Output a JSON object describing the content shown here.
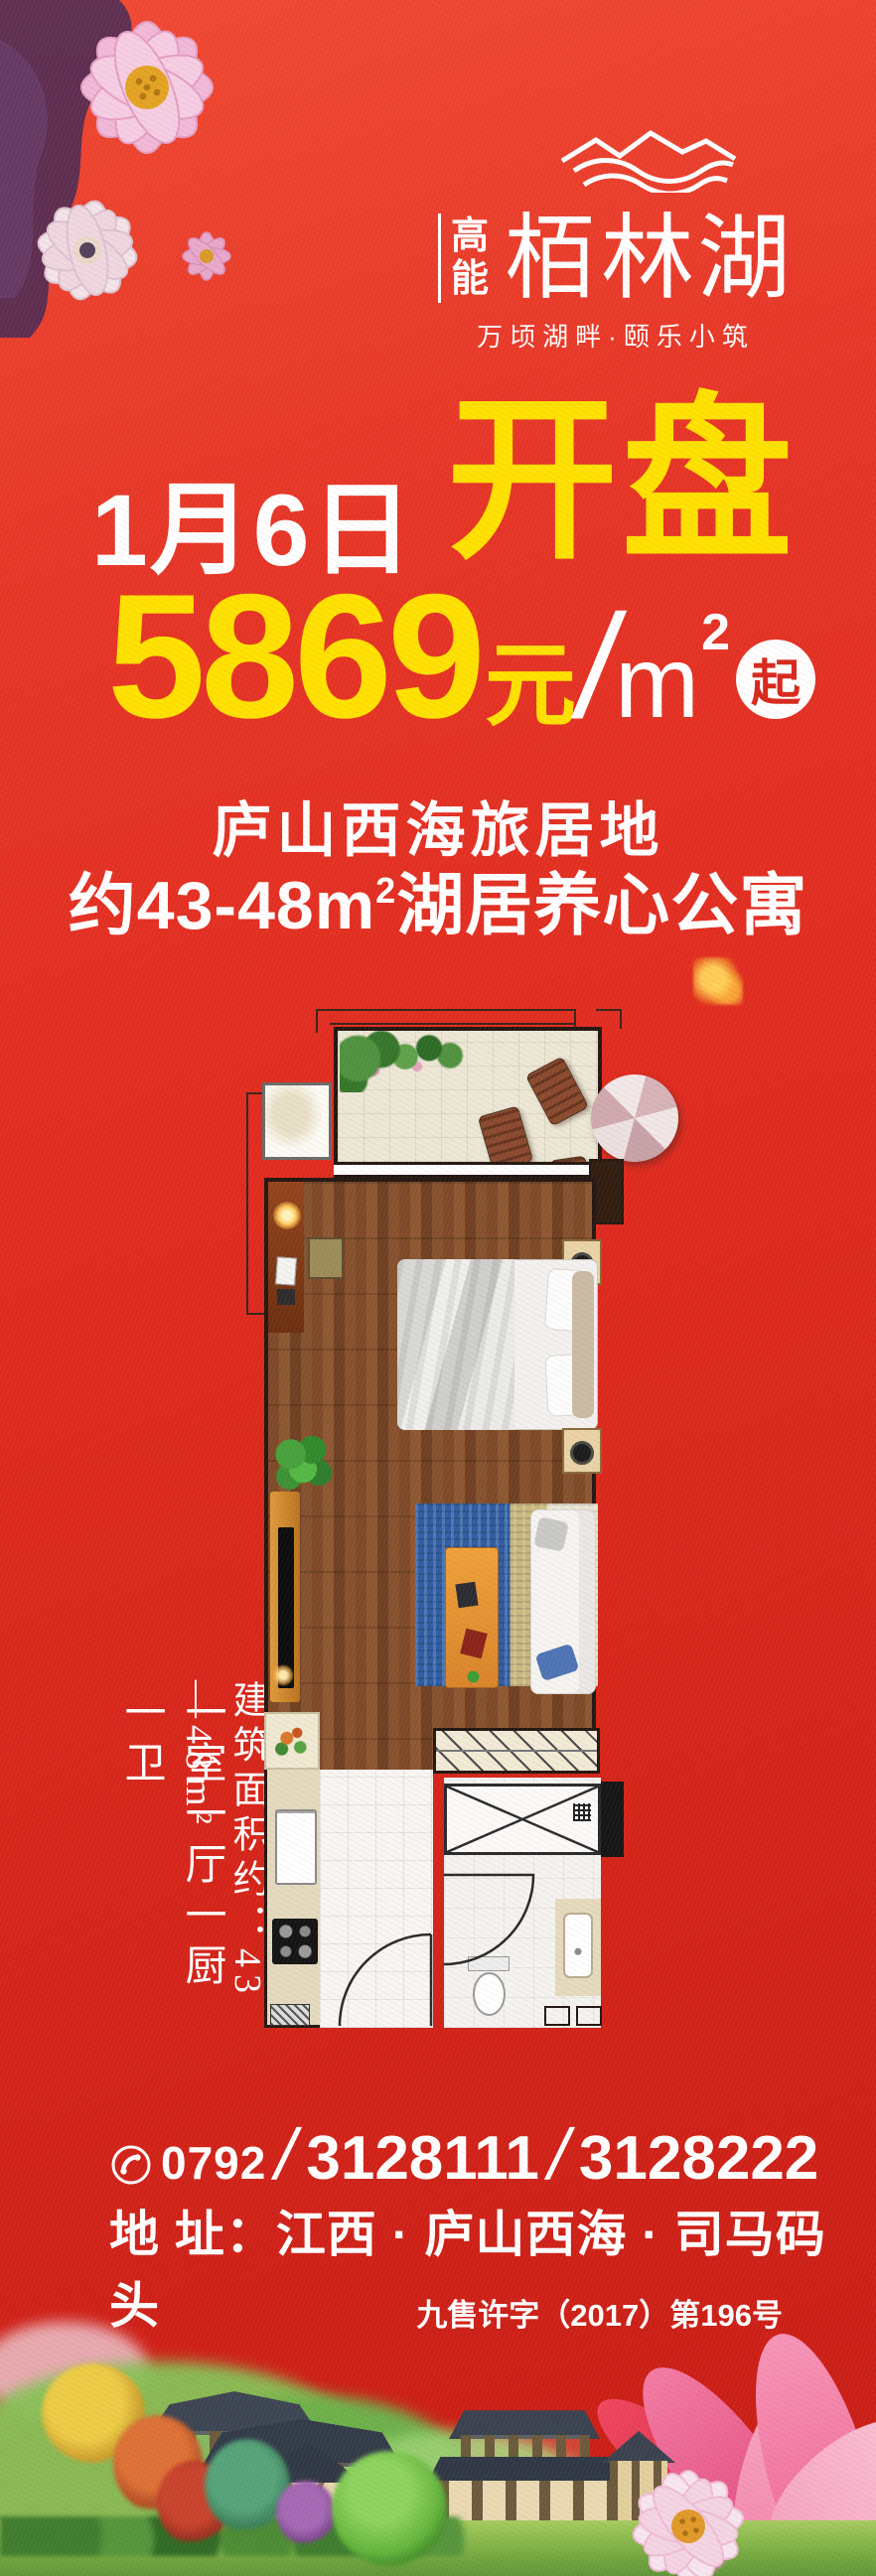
{
  "logo": {
    "waves_icon": "lake-waves-icon",
    "brand_prefix_top": "高",
    "brand_prefix_bottom": "能",
    "brand_name": "栢林湖",
    "tagline": "万顷湖畔·颐乐小筑"
  },
  "headline": {
    "date": "1月6日",
    "event": "开盘"
  },
  "price": {
    "amount": "5869",
    "currency_unit": "元",
    "separator": "/",
    "area_unit": "m",
    "area_sup": "2",
    "badge": "起"
  },
  "subtitles": {
    "line1": "庐山西海旅居地",
    "line2_prefix": "约43-48",
    "line2_unit": "m",
    "line2_sup": "2",
    "line2_suffix": "湖居养心公寓"
  },
  "floorplan_labels": {
    "area": "建筑面积约：43—48m²",
    "rooms": "一室一厅一厨一卫"
  },
  "contact": {
    "area_code": "0792",
    "slash1": "/",
    "phone1": "3128111",
    "slash2": "/",
    "phone2": "3128222",
    "address": "地 址：江西 · 庐山西海 · 司马码头",
    "license": "九售许字（2017）第196号"
  },
  "colors": {
    "background_red": "#e02b1f",
    "accent_yellow": "#ffe100",
    "text_white": "#ffffff",
    "badge_red": "#d7281d"
  }
}
